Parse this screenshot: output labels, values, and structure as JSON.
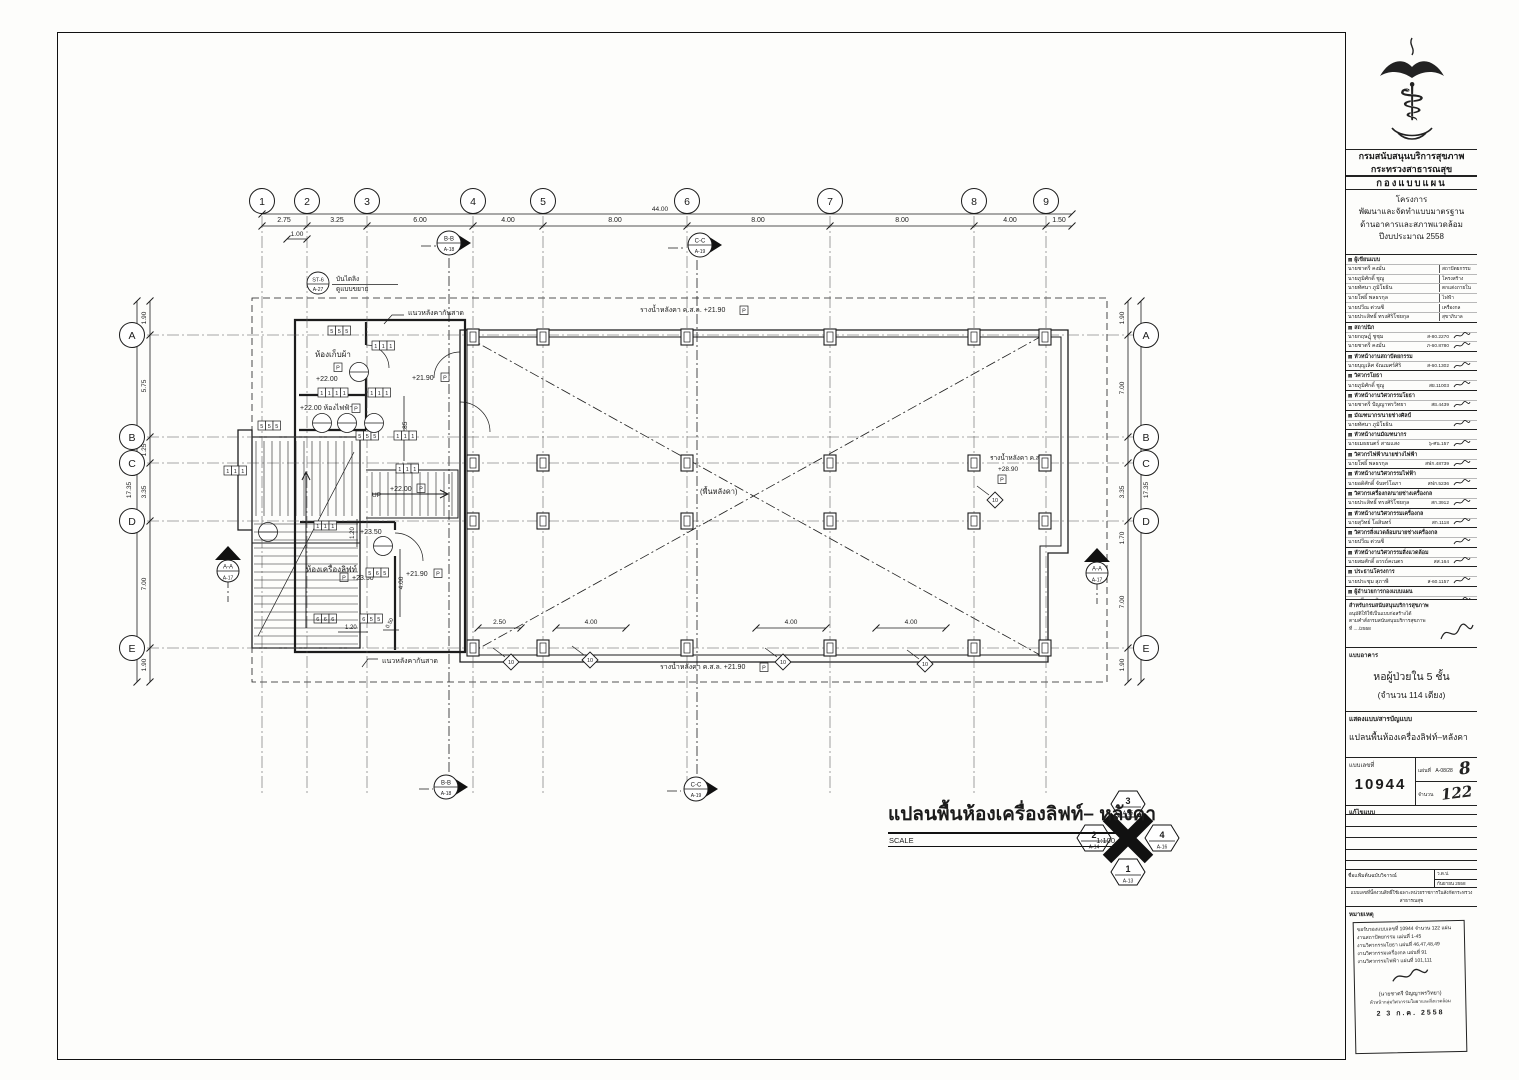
{
  "icons": {
    "logo_glyph": "⚕",
    "section_marker": "▤"
  },
  "titleblock": {
    "agency_line1": "กรมสนับสนุนบริการสุขภาพ",
    "agency_line2": "กระทรวงสาธารณสุข",
    "division": "กองแบบแผน",
    "project_label": "โครงการ",
    "project_lines": [
      "พัฒนาและจัดทำแบบมาตรฐาน",
      "ด้านอาคารและสภาพแวดล้อม",
      "ปีงบประมาณ 2558"
    ],
    "personnel": [
      {
        "h": "ผู้เขียนแบบ",
        "rows": [
          {
            "n": "นายชาตรี คงมั่น",
            "r": "สถาปัตยกรรม"
          },
          {
            "n": "นายภูมิศักดิ์ ชูญู",
            "r": "โครงสร้าง"
          },
          {
            "n": "นายทัศนา ภูมิโยธิน",
            "r": "ตกแต่งภายใน"
          },
          {
            "n": "นายโพธิ์ พลธรกุล",
            "r": "ไฟฟ้า"
          },
          {
            "n": "นายปวีณ ต่วนซี",
            "r": "เครื่องกล"
          },
          {
            "n": "นายประสิทธิ์ ทรงศิริโชยกุล",
            "r": "สุขาภิบาล"
          }
        ]
      },
      {
        "h": "สถาปนิก",
        "rows": [
          {
            "n": "นายกฤษฎุ์ ชูชุม",
            "c": "ส-80.2270",
            "s": 1
          },
          {
            "n": "นายชาตรี คงมั่น",
            "c": "ภ-60.8780",
            "s": 1
          }
        ]
      },
      {
        "h": "หัวหน้างานสถาปัตยกรรม",
        "rows": [
          {
            "n": "นายบุญเลิศ จัณเมศร์ศิริ",
            "c": "ส-60.1302",
            "s": 1
          }
        ]
      },
      {
        "h": "วิศวกรโยธา",
        "rows": [
          {
            "n": "นายภูมิศักดิ์ ชูญู",
            "c": "สย.11003",
            "s": 1
          }
        ]
      },
      {
        "h": "หัวหน้างานวิศวกรรมโยธา",
        "rows": [
          {
            "n": "นายชาตรี ปัญญาพรวิทยา",
            "c": "สย.4439",
            "s": 1
          }
        ]
      },
      {
        "h": "มัณฑนากร/นายช่างศิลป์",
        "rows": [
          {
            "n": "นายทัศนา ภูมิโยธิน",
            "c": "",
            "s": 1
          }
        ]
      },
      {
        "h": "หัวหน้างานมัณฑนากร",
        "rows": [
          {
            "n": "นายเมธยนตร์ สามแสง",
            "c": "๖-ศน.157",
            "s": 1
          }
        ]
      },
      {
        "h": "วิศวกรไฟฟ้า/นายช่างไฟฟ้า",
        "rows": [
          {
            "n": "นายโพธิ์ พลธรกุล",
            "c": "สฟก.48739",
            "s": 1
          }
        ]
      },
      {
        "h": "หัวหน้างานวิศวกรรมไฟฟ้า",
        "rows": [
          {
            "n": "นายอดิศักดิ์ จันทร์โอภา",
            "c": "สฟก.5236",
            "s": 1
          }
        ]
      },
      {
        "h": "วิศวกรเครื่องกล/นายช่างเครื่องกล",
        "rows": [
          {
            "n": "นายประสิทธิ์ ทรงศิริโชยกุล",
            "c": "สก.3912",
            "s": 1
          }
        ]
      },
      {
        "h": "หัวหน้างานวิศวกรรมเครื่องกล",
        "rows": [
          {
            "n": "นายสุวิทย์ โอสินทร์",
            "c": "สก.1118",
            "s": 1
          }
        ]
      },
      {
        "h": "วิศวกรสิ่งแวดล้อม/นายช่างเครื่องกล",
        "rows": [
          {
            "n": "นายปวีณ ต่วนซี",
            "c": "",
            "s": 1
          }
        ]
      },
      {
        "h": "หัวหน้างานวิศวกรรมสิ่งแวดล้อม",
        "rows": [
          {
            "n": "นายสมศักดิ์ อรรถ์คเนตร",
            "c": "สส.164",
            "s": 1
          }
        ]
      },
      {
        "h": "ประธานโครงการ",
        "rows": [
          {
            "n": "นายประชุม สุภาพี",
            "c": "ส-60.1157",
            "s": 1
          }
        ]
      },
      {
        "h": "ผู้อำนวยการกองแบบแผน",
        "rows": [
          {
            "n": "นายศรี ดานุสิธรรม",
            "c": "วล.1626",
            "s": 1
          }
        ]
      }
    ],
    "approval": {
      "h": "สำหรับกรมสนับสนุนบริการสุขภาพ",
      "lines": [
        "อนุมัติให้ใช้เป็นแบบก่อสร้างได้",
        "ตามคำสั่งกรมสนับสนุนบริการสุขภาพ",
        "ที่ ..../2558"
      ]
    },
    "building_label": "แบบอาคาร",
    "building_name": "หอผู้ป่วยใน 5 ชั้น",
    "building_sub": "(จำนวน 114 เตียง)",
    "content_label": "แสดงแบบ/สารบัญแบบ",
    "content_name": "แปลนพื้นห้องเครื่องลิฟท์–หลังคา",
    "number_label": "แบบเลขที่",
    "number_value": "10944",
    "sheet_label": "แผ่นที่",
    "sheet_value": "A-08/28",
    "sheet_hand": "8",
    "count_label": "จำนวน",
    "count_hand": "122",
    "revision_label": "แก้ไขแบบ",
    "file_label": "ชื่อแฟ้มต้นฉบับวิจารณ์",
    "date_label": "ว.ด.ป.",
    "date_value": "กันยายน 2558",
    "notice_lines": [
      "แบบเลขที่นี้สงวนสิทธิ์ใช้เฉพาะหน่วยราชการในสังกัดกระทรวงสาธารณสุข",
      "ห้ามนำไปใช้ก่อสร้างโดยไม่ได้รับอนุญาต"
    ],
    "remark_label": "หมายเหตุ",
    "stamp": {
      "lines": [
        "ขอรับรองแบบเลขที่ 10944 จำนวน 122 แผ่น",
        "งานสถาปัตยกรรม แผ่นที่ 1-45",
        "งานวิศวกรรมโยธา แผ่นที่ 46,47,48,49",
        "งานวิศวกรรมเครื่องกล แผ่นที่ 91",
        "งานวิศวกรรมไฟฟ้า แผ่นที่ 101,111"
      ],
      "sign_name": "(นายชาตรี ปัญญาพรวิทยา)",
      "sign_title": "หัวหน้ากลุ่มวิศวกรรมโยธาและสิ่งแวดล้อม",
      "date": "2 3 ก.ค. 2558"
    }
  },
  "plan": {
    "cols": [
      {
        "n": "1",
        "x": 262
      },
      {
        "n": "2",
        "x": 307
      },
      {
        "n": "3",
        "x": 367
      },
      {
        "n": "4",
        "x": 473
      },
      {
        "n": "5",
        "x": 543
      },
      {
        "n": "6",
        "x": 687
      },
      {
        "n": "7",
        "x": 830
      },
      {
        "n": "8",
        "x": 974
      },
      {
        "n": "9",
        "x": 1046
      }
    ],
    "col_dims": [
      {
        "t": "2.75",
        "x": 284
      },
      {
        "t": "3.25",
        "x": 337
      },
      {
        "t": "6.00",
        "x": 420
      },
      {
        "t": "4.00",
        "x": 508
      },
      {
        "t": "8.00",
        "x": 615
      },
      {
        "t": "8.00",
        "x": 758
      },
      {
        "t": "8.00",
        "x": 902
      },
      {
        "t": "4.00",
        "x": 1010
      },
      {
        "t": "1.50",
        "x": 1059
      }
    ],
    "overall_width": {
      "t": "44.00",
      "x": 660,
      "y": 211
    },
    "sub_dim": {
      "t": "1.00",
      "x": 297,
      "y": 236
    },
    "rows": [
      {
        "n": "A",
        "y": 335
      },
      {
        "n": "B",
        "y": 437
      },
      {
        "n": "C",
        "y": 463
      },
      {
        "n": "D",
        "y": 521
      },
      {
        "n": "E",
        "y": 648
      }
    ],
    "left_dims": [
      {
        "t": "1.90",
        "y": 318
      },
      {
        "t": "5.75",
        "y": 386
      },
      {
        "t": "1.25",
        "y": 450
      },
      {
        "t": "3.35",
        "y": 492
      },
      {
        "t": "7.00",
        "y": 584
      },
      {
        "t": "1.90",
        "y": 665
      }
    ],
    "left_total": {
      "t": "17.35",
      "x": 131,
      "y": 490
    },
    "right_dims": [
      {
        "t": "1.90",
        "y": 318
      },
      {
        "t": "7.00",
        "y": 388
      },
      {
        "t": "3.35",
        "y": 492
      },
      {
        "t": "1.70",
        "y": 538
      },
      {
        "t": "7.00",
        "y": 602
      },
      {
        "t": "1.90",
        "y": 665
      }
    ],
    "right_total": {
      "t": "17.35",
      "x": 1148,
      "y": 490
    },
    "bottom_dims": [
      {
        "t": "2.50",
        "x1": 478,
        "x2": 521,
        "y": 628
      },
      {
        "t": "4.00",
        "x1": 556,
        "x2": 626,
        "y": 628
      },
      {
        "t": "4.00",
        "x1": 756,
        "x2": 826,
        "y": 628
      },
      {
        "t": "4.00",
        "x1": 876,
        "x2": 946,
        "y": 628
      }
    ],
    "ann": [
      {
        "t": "แนวหลังคากันสาด",
        "x": 408,
        "y": 315,
        "fs": 7
      },
      {
        "t": "แนวหลังคากันสาด",
        "x": 382,
        "y": 663,
        "fs": 7
      },
      {
        "t": "รางน้ำหลังคา ค.ส.ล.  +21.90",
        "x": 640,
        "y": 312,
        "fs": 7
      },
      {
        "t": "รางน้ำหลังคา ค.ส.ล.  +21.90",
        "x": 660,
        "y": 669,
        "fs": 7
      },
      {
        "t": "รางน้ำหลังคา ค.ส.ล.",
        "x": 990,
        "y": 460,
        "fs": 6.5
      },
      {
        "t": "+28.90",
        "x": 998,
        "y": 471,
        "fs": 6.5
      },
      {
        "t": "ห้องเก็บผ้า",
        "x": 315,
        "y": 357,
        "fs": 8
      },
      {
        "t": "+22.00",
        "x": 316,
        "y": 381,
        "fs": 7
      },
      {
        "t": "+22.00 ห้องไฟฟ้า",
        "x": 300,
        "y": 410,
        "fs": 7
      },
      {
        "t": "ห้องเครื่องลิฟท์",
        "x": 306,
        "y": 572,
        "fs": 8
      },
      {
        "t": "+23.50",
        "x": 352,
        "y": 580,
        "fs": 7
      },
      {
        "t": "+23.50",
        "x": 360,
        "y": 534,
        "fs": 7
      },
      {
        "t": "+21.90",
        "x": 412,
        "y": 380,
        "fs": 7
      },
      {
        "t": "+22.00",
        "x": 390,
        "y": 491,
        "fs": 7
      },
      {
        "t": "+21.90",
        "x": 406,
        "y": 576,
        "fs": 7
      },
      {
        "t": "(พื้นหลังคา)",
        "x": 700,
        "y": 494,
        "fs": 7.5
      },
      {
        "t": "UP",
        "x": 372,
        "y": 497,
        "fs": 6.5
      },
      {
        "t": "บันไดลิง",
        "x": 336,
        "y": 281,
        "fs": 6.5
      },
      {
        "t": "ดูแบบขยาย",
        "x": 336,
        "y": 291,
        "fs": 6.5
      },
      {
        "t": "1.85",
        "x": 407,
        "y": 428,
        "fs": 6.5,
        "r": -90
      },
      {
        "t": "1.20",
        "x": 354,
        "y": 533,
        "fs": 6,
        "r": -90
      },
      {
        "t": "4.00",
        "x": 403,
        "y": 583,
        "fs": 6.5,
        "r": -90
      },
      {
        "t": "0.50",
        "x": 391,
        "y": 624,
        "fs": 5.5,
        "r": -60
      },
      {
        "t": "1.20",
        "x": 345,
        "y": 629,
        "fs": 6
      }
    ],
    "pboxes": [
      {
        "t": "P",
        "x": 740,
        "y": 306
      },
      {
        "t": "P",
        "x": 760,
        "y": 663
      },
      {
        "t": "P",
        "x": 998,
        "y": 475
      },
      {
        "t": "P",
        "x": 334,
        "y": 363
      },
      {
        "t": "P",
        "x": 352,
        "y": 404
      },
      {
        "t": "P",
        "x": 340,
        "y": 573
      },
      {
        "t": "P",
        "x": 441,
        "y": 373
      },
      {
        "t": "P",
        "x": 434,
        "y": 569
      },
      {
        "t": "P",
        "x": 417,
        "y": 484
      }
    ],
    "tags": [
      {
        "x": 328,
        "y": 326,
        "c": [
          "5",
          "5",
          "5"
        ]
      },
      {
        "x": 372,
        "y": 341,
        "c": [
          "1",
          "1",
          "1"
        ]
      },
      {
        "x": 318,
        "y": 388,
        "c": [
          "1",
          "1",
          "1",
          "1"
        ]
      },
      {
        "x": 368,
        "y": 388,
        "c": [
          "1",
          "1",
          "1"
        ]
      },
      {
        "x": 258,
        "y": 421,
        "c": [
          "5",
          "5",
          "5"
        ]
      },
      {
        "x": 224,
        "y": 466,
        "c": [
          "1",
          "1",
          "1"
        ]
      },
      {
        "x": 356,
        "y": 431,
        "c": [
          "5",
          "5",
          "5"
        ]
      },
      {
        "x": 394,
        "y": 431,
        "c": [
          "1",
          "1",
          "1"
        ]
      },
      {
        "x": 314,
        "y": 521,
        "c": [
          "1",
          "1",
          "1"
        ]
      },
      {
        "x": 396,
        "y": 464,
        "c": [
          "1",
          "1",
          "1"
        ]
      },
      {
        "x": 366,
        "y": 568,
        "c": [
          "5",
          "6",
          "5"
        ]
      },
      {
        "x": 314,
        "y": 614,
        "c": [
          "6",
          "6",
          "6"
        ]
      },
      {
        "x": 360,
        "y": 614,
        "c": [
          "6",
          "5",
          "5"
        ]
      }
    ],
    "diamonds": [
      {
        "t": "10",
        "x": 511,
        "y": 662
      },
      {
        "t": "10",
        "x": 590,
        "y": 660
      },
      {
        "t": "10",
        "x": 783,
        "y": 662
      },
      {
        "t": "10",
        "x": 925,
        "y": 664
      },
      {
        "t": "10",
        "x": 995,
        "y": 500
      }
    ],
    "markers": [
      {
        "top": "B-B",
        "bot": "A-18",
        "x": 449,
        "y": 243,
        "kind": "right"
      },
      {
        "top": "C-C",
        "bot": "A-19",
        "x": 700,
        "y": 245,
        "kind": "right"
      },
      {
        "top": "B-B",
        "bot": "A-18",
        "x": 446,
        "y": 787,
        "kind": "right"
      },
      {
        "top": "C-C",
        "bot": "A-19",
        "x": 696,
        "y": 789,
        "kind": "right"
      },
      {
        "top": "A-A",
        "bot": "A-17",
        "x": 228,
        "y": 560,
        "kind": "up"
      },
      {
        "top": "A-A",
        "bot": "A-17",
        "x": 1097,
        "y": 562,
        "kind": "up"
      }
    ],
    "st_note": {
      "code": "ST-6",
      "ref": "A-27",
      "x": 318,
      "y": 283
    },
    "circle_tags": [
      [
        322,
        423
      ],
      [
        347,
        423
      ],
      [
        374,
        423
      ],
      [
        268,
        532
      ],
      [
        383,
        546
      ],
      [
        359,
        372
      ]
    ],
    "columns": {
      "xs": [
        473,
        543,
        687,
        830,
        974,
        1045
      ],
      "ys": [
        337,
        463,
        521,
        648
      ]
    }
  },
  "plan_title": {
    "text": "แปลนพื้นห้องเครื่องลิฟท์– หลังคา",
    "scale_label": "SCALE",
    "scale_value": "1:100"
  },
  "keyplan": {
    "n": {
      "no": "3",
      "ref": "A-15"
    },
    "s": {
      "no": "1",
      "ref": "A-13"
    },
    "w": {
      "no": "2",
      "ref": "A-14"
    },
    "e": {
      "no": "4",
      "ref": "A-16"
    }
  }
}
